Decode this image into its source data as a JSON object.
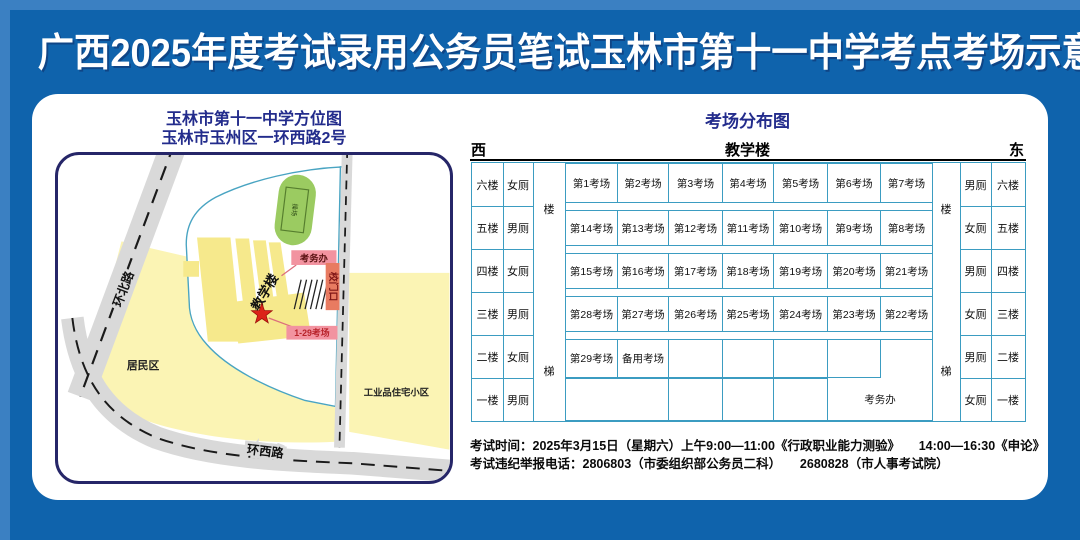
{
  "page": {
    "title": "广西2025年度考试录用公务员笔试玉林市第十一中学考点考场示意图"
  },
  "colors": {
    "background_blue": "#0F63AC",
    "heading_navy": "#232C8C",
    "table_border_teal": "#3B9CC1",
    "area_yellow": "#FBF4B4",
    "building_yellow": "#F6E98C",
    "field_green": "#9BCB61",
    "label_pink": "#F293A0",
    "gate_red": "#E87B61",
    "star_red": "#DC2318"
  },
  "map": {
    "title_line1": "玉林市第十一中学方位图",
    "title_line2": "玉林市玉州区一环西路2号",
    "road_north": "环北路",
    "road_west": "环西路",
    "residential": "居民区",
    "industrial": "工业品住宅小区",
    "teaching_building": "教学楼",
    "field": "操场",
    "exam_office": "考务办",
    "school_gate": "校门口",
    "exam_rooms_range": "1-29考场"
  },
  "distribution": {
    "title": "考场分布图",
    "west": "西",
    "building": "教学楼",
    "east": "东",
    "stairs": {
      "top": "楼",
      "bottom": "梯"
    },
    "floors_left": [
      "六楼",
      "五楼",
      "四楼",
      "三楼",
      "二楼",
      "一楼"
    ],
    "toilets_left": [
      "女厕",
      "男厕",
      "女厕",
      "男厕",
      "女厕",
      "男厕"
    ],
    "toilets_right": [
      "男厕",
      "女厕",
      "男厕",
      "女厕",
      "男厕",
      "女厕"
    ],
    "floors_right": [
      "六楼",
      "五楼",
      "四楼",
      "三楼",
      "二楼",
      "一楼"
    ],
    "exam_rows": [
      [
        "第1考场",
        "第2考场",
        "第3考场",
        "第4考场",
        "第5考场",
        "第6考场",
        "第7考场"
      ],
      [
        "第14考场",
        "第13考场",
        "第12考场",
        "第11考场",
        "第10考场",
        "第9考场",
        "第8考场"
      ],
      [
        "第15考场",
        "第16考场",
        "第17考场",
        "第18考场",
        "第19考场",
        "第20考场",
        "第21考场"
      ],
      [
        "第28考场",
        "第27考场",
        "第26考场",
        "第25考场",
        "第24考场",
        "第23考场",
        "第22考场"
      ],
      [
        "第29考场",
        "备用考场",
        "",
        "",
        "",
        "",
        ""
      ]
    ],
    "ground_floor": {
      "cells": [
        "",
        "",
        "",
        ""
      ],
      "office": "考务办"
    }
  },
  "footer": {
    "line1": "考试时间：2025年3月15日（星期六）上午9:00—11:00《行政职业能力测验》　　14:00—16:30《申论》",
    "line2": "考试违纪举报电话：2806803（市委组织部公务员二科）　　2680828（市人事考试院）"
  }
}
